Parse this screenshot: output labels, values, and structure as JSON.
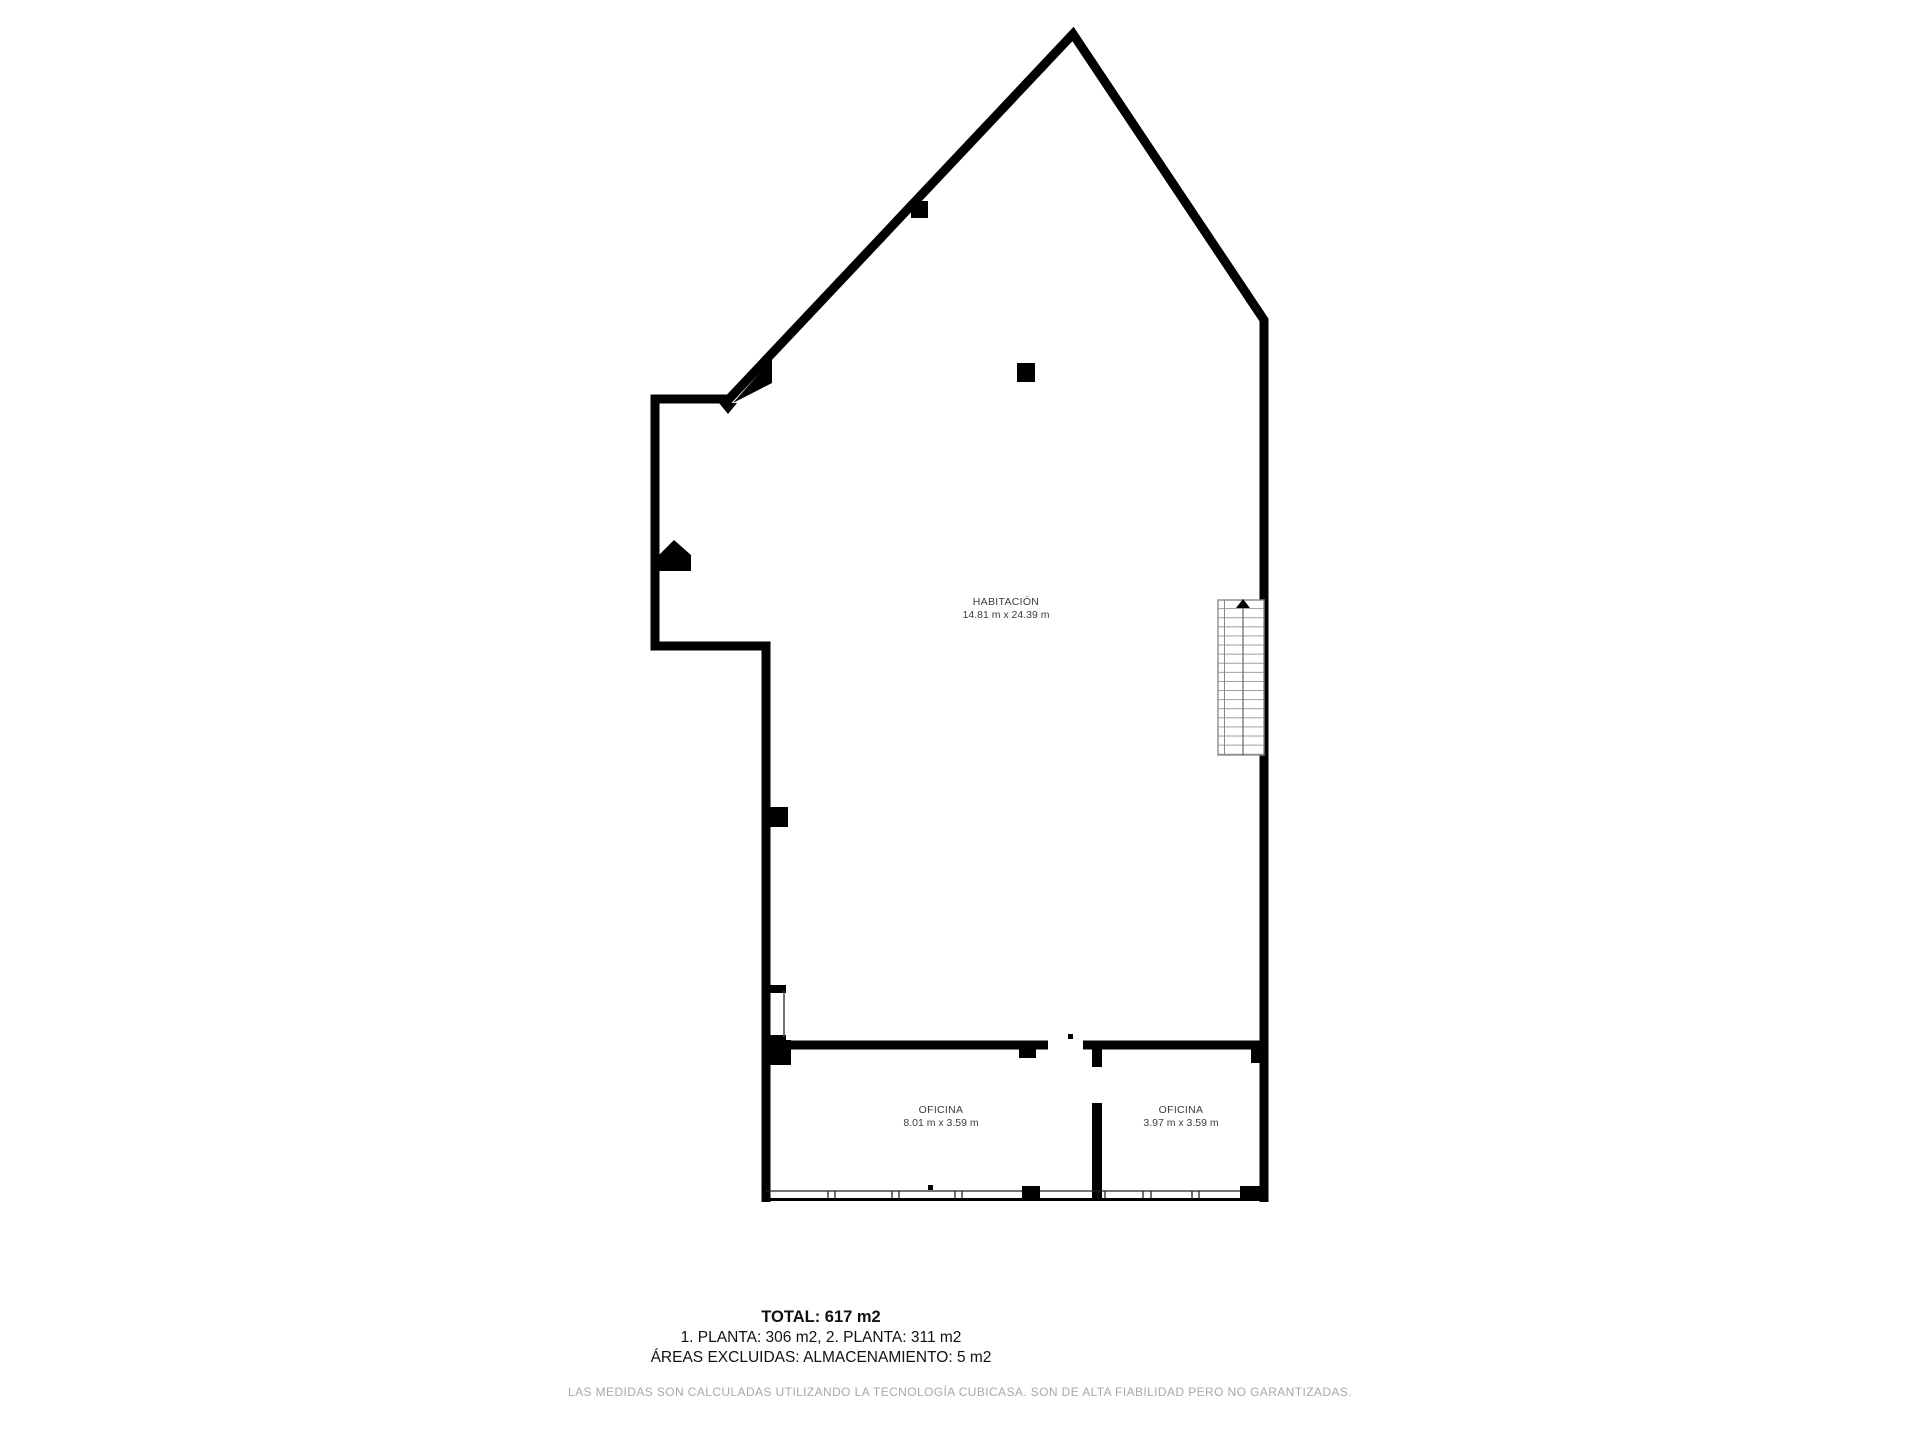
{
  "floor_plan": {
    "rooms": [
      {
        "id": "habitacion",
        "name": "HABITACIÓN",
        "dimensions": "14.81 m x 24.39 m"
      },
      {
        "id": "oficina-1",
        "name": "OFICINA",
        "dimensions": "8.01 m x 3.59 m"
      },
      {
        "id": "oficina-2",
        "name": "OFICINA",
        "dimensions": "3.97 m x 3.59 m"
      }
    ],
    "features": [
      "staircase",
      "stairs-up-arrow",
      "column",
      "window-band",
      "door-openings"
    ]
  },
  "summary": {
    "total": "TOTAL: 617 m2",
    "plantas": "1. PLANTA: 306 m2, 2. PLANTA: 311 m2",
    "excluidas": "ÁREAS EXCLUIDAS: ALMACENAMIENTO: 5 m2"
  },
  "footer": {
    "disclaimer": "LAS MEDIDAS SON CALCULADAS UTILIZANDO LA TECNOLOGÍA CUBICASA. SON DE ALTA FIABILIDAD PERO NO GARANTIZADAS."
  },
  "colors": {
    "wall": "#000000",
    "room_label": "#3d3d3d",
    "summary_text": "#111111",
    "footer_text": "#a8a8a8",
    "stair_lines": "#8a8a8a",
    "background": "#ffffff"
  }
}
